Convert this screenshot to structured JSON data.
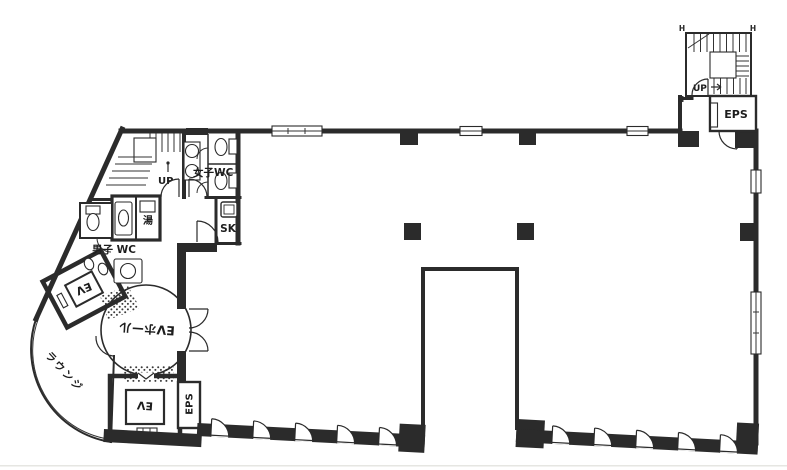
{
  "floor_plan": {
    "kind": "scanned architectural floor plan of an office building floor",
    "labels": {
      "elevator_hall": "EVホール",
      "lounge": "ラウンジ",
      "mens_wc": "男子 WC",
      "womens_wc": "女子WC",
      "hot_water": "湯",
      "sink_closet": "SK",
      "eps_top": "EPS",
      "eps_bottom": "EPS",
      "elevator_top": "EV",
      "elevator_bottom": "EV",
      "stair_up_left": "UP",
      "stair_up_right": "UP",
      "handrail_mark": "H"
    },
    "colors": {
      "ink": "#2b2b2b",
      "paper": "#ffffff",
      "stipple": "#3a3a3a"
    }
  }
}
